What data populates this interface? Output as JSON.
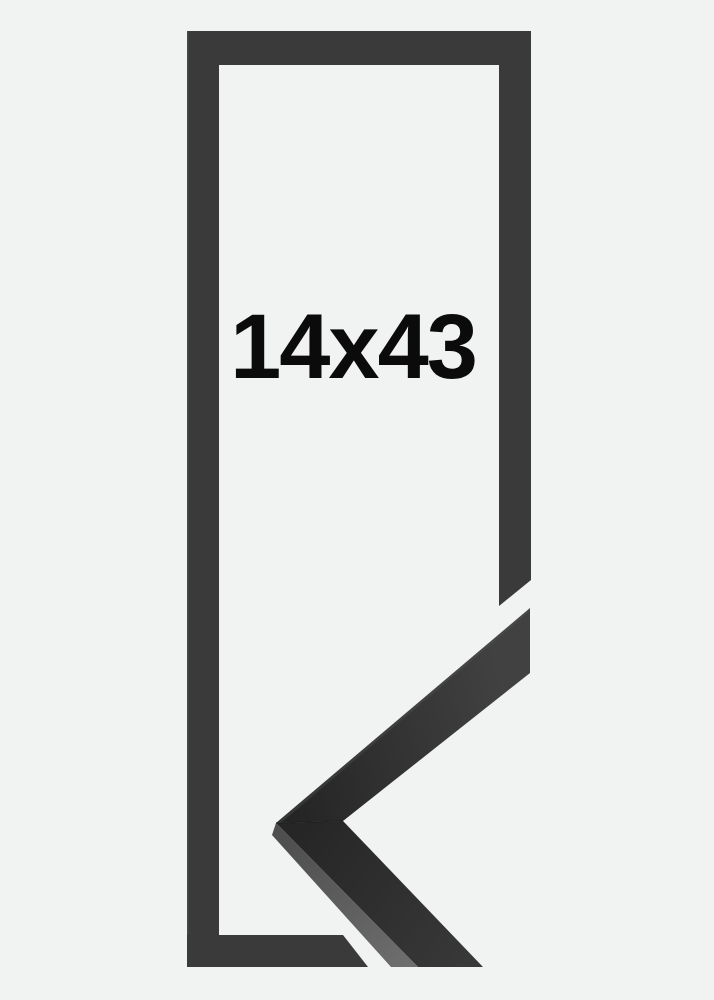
{
  "product": {
    "size_label": "14x43"
  },
  "colors": {
    "background": "#f1f2f2",
    "frame": "#3a3a3a",
    "frame_edge_highlight": "#5a5a5a",
    "label_text": "#0b0b0b",
    "sample_face_dark": "#232323",
    "sample_face_light": "#414141",
    "sample_side": "#686868",
    "miter_seam": "#1c1c1c"
  }
}
